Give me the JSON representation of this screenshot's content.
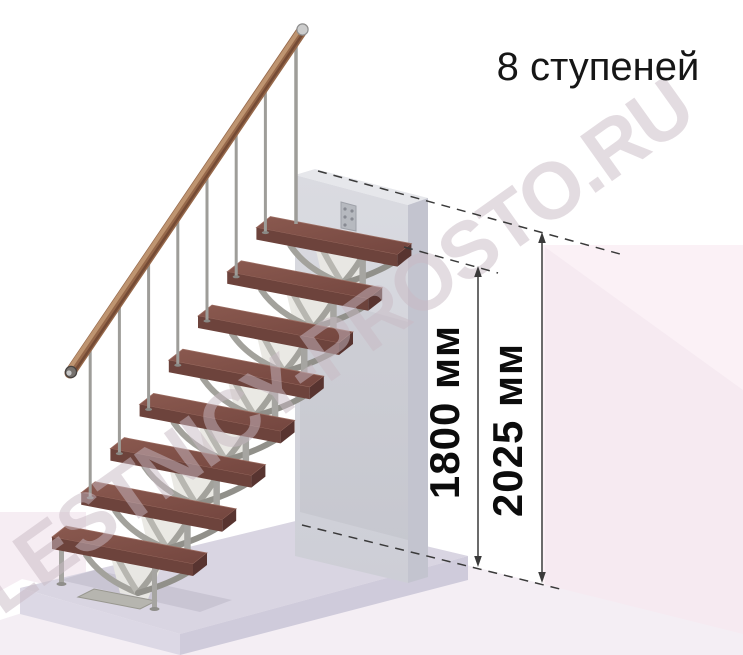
{
  "header": {
    "steps_label": "8 ступеней"
  },
  "dimensions": {
    "to_top_step": "1800 мм",
    "to_floor_above": "2025 мм"
  },
  "watermark": "LESTNICY-PROSTO.RU",
  "scene": {
    "steps_count": 8,
    "colors": {
      "tread_top_light": "#8a594f",
      "tread_top_dark": "#74463f",
      "tread_front": "#6d433c",
      "tread_end": "#583430",
      "handrail": "#96684a",
      "handrail_light": "#c59c77",
      "handrail_dark": "#6e4530",
      "metal": "#a6a5a1",
      "metal_dark": "#8f8e8a",
      "bracket_plate": "#e9e8e3",
      "arm_light": "#b8b7b1",
      "arm_mid": "#a3a29c",
      "arm_dark": "#91908a",
      "wall_front": "#d6d7dd",
      "wall_side": "#c3c4cf",
      "wall_top": "#e6e7eb",
      "slab_top": "#d9d5e2",
      "slab_left": "#dcd8e5",
      "slab_right": "#cfcbdb",
      "pink_light": "#fbf1f6",
      "pink_mid": "#f6eaf1",
      "pink_floor": "#f4eef4",
      "pink_left": "#f6edf3",
      "dim_line": "#3a3a3a"
    }
  }
}
